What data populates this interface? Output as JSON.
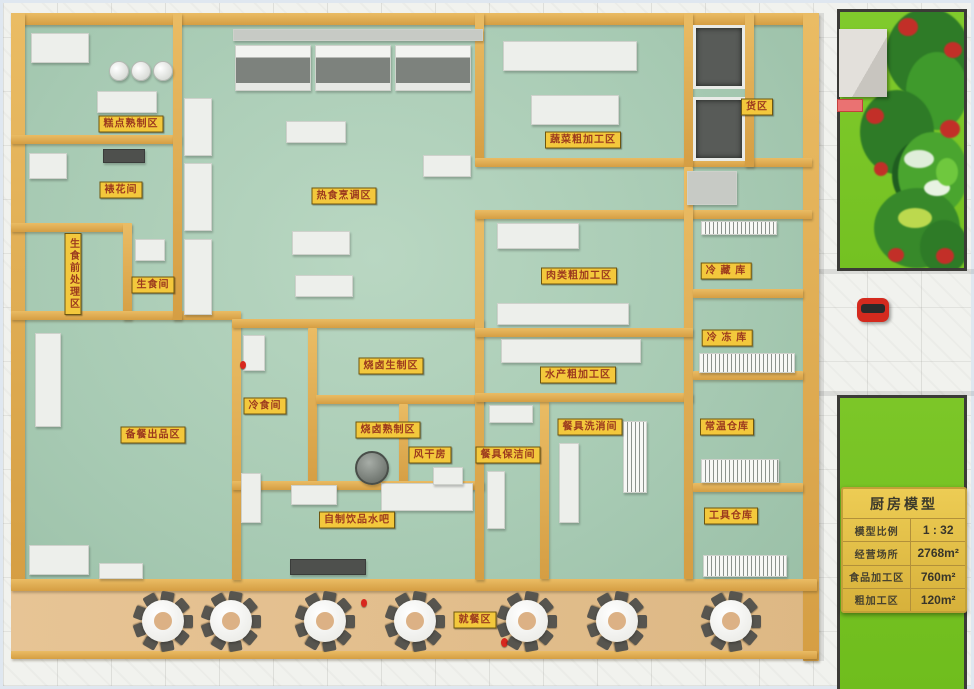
{
  "photo": {
    "zone_labels": [
      {
        "id": "pastry-cooked-zone",
        "text": "糕点熟制区",
        "x": 128,
        "y": 121
      },
      {
        "id": "cake-decorating-room",
        "text": "裱花间",
        "x": 118,
        "y": 187
      },
      {
        "id": "raw-food-preprocessing-zone",
        "text": "生食前处理区",
        "x": 70,
        "y": 271,
        "vertical": true
      },
      {
        "id": "raw-food-room",
        "text": "生食间",
        "x": 150,
        "y": 282
      },
      {
        "id": "hot-food-cooking-zone",
        "text": "热食烹调区",
        "x": 341,
        "y": 193
      },
      {
        "id": "vegetable-rough-processing-zone",
        "text": "蔬菜粗加工区",
        "x": 580,
        "y": 137
      },
      {
        "id": "goods-zone",
        "text": "货区",
        "x": 754,
        "y": 104
      },
      {
        "id": "meat-rough-processing-zone",
        "text": "肉类粗加工区",
        "x": 576,
        "y": 273
      },
      {
        "id": "cold-storage",
        "text": "冷 藏 库",
        "x": 723,
        "y": 268
      },
      {
        "id": "freezer-storage",
        "text": "冷 冻 库",
        "x": 724,
        "y": 335
      },
      {
        "id": "braise-raw-zone",
        "text": "烧卤生制区",
        "x": 388,
        "y": 363
      },
      {
        "id": "aquatic-rough-processing-zone",
        "text": "水产粗加工区",
        "x": 575,
        "y": 372
      },
      {
        "id": "cold-food-room",
        "text": "冷食间",
        "x": 262,
        "y": 403
      },
      {
        "id": "braise-cooked-zone",
        "text": "烧卤熟制区",
        "x": 385,
        "y": 427
      },
      {
        "id": "air-drying-room",
        "text": "风干房",
        "x": 427,
        "y": 452
      },
      {
        "id": "tableware-keeping-room",
        "text": "餐具保洁间",
        "x": 505,
        "y": 452
      },
      {
        "id": "tableware-washing-room",
        "text": "餐具洗消间",
        "x": 587,
        "y": 424
      },
      {
        "id": "ambient-warehouse",
        "text": "常温仓库",
        "x": 724,
        "y": 424
      },
      {
        "id": "meal-prep-output-zone",
        "text": "备餐出品区",
        "x": 150,
        "y": 432
      },
      {
        "id": "house-made-drink-bar",
        "text": "自制饮品水吧",
        "x": 354,
        "y": 517
      },
      {
        "id": "tool-warehouse",
        "text": "工具仓库",
        "x": 728,
        "y": 513
      },
      {
        "id": "dining-zone",
        "text": "就餐区",
        "x": 472,
        "y": 617
      }
    ],
    "info_board": {
      "title": "厨房模型",
      "rows": [
        {
          "label": "模型比例",
          "value": "1 : 32"
        },
        {
          "label": "经营场所",
          "value": "2768m²"
        },
        {
          "label": "食品加工区",
          "value": "760m²"
        },
        {
          "label": "粗加工区",
          "value": "120m²"
        }
      ]
    },
    "colors": {
      "kitchen_floor": "#a7cab3",
      "wall": "#dda94e",
      "label_bg": "#f3c83c",
      "label_text": "#9c3a1e",
      "dining_floor": "#e2bf8e",
      "grass": "#7cc628",
      "info_board": "#e3bf4a",
      "car": "#d42a1e"
    }
  }
}
